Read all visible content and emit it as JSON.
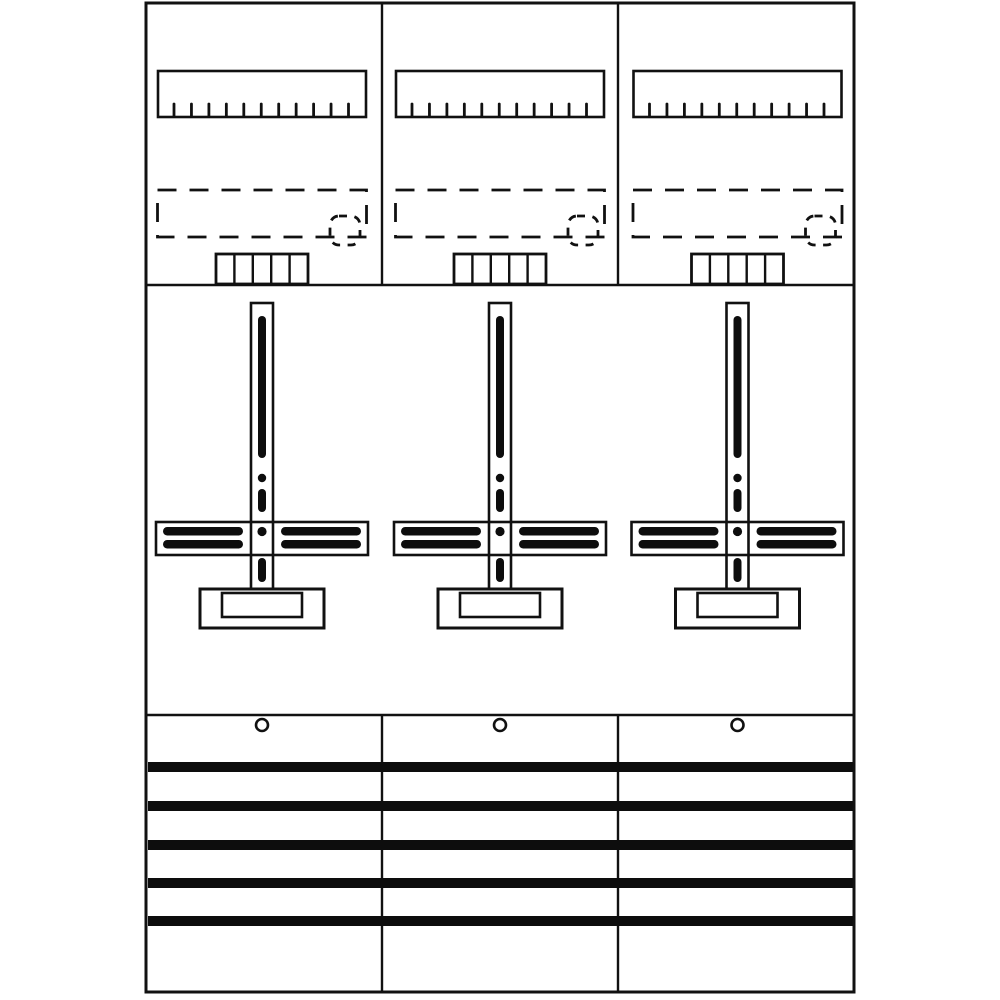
{
  "title": "meter-panel-technical-drawing",
  "colors": {
    "background": "#ffffff",
    "line": "#111111",
    "fill_black": "#0d0d0d",
    "fill_white": "#ffffff"
  },
  "drawing": {
    "canvas": {
      "width": 1000,
      "height": 1000
    },
    "frame": {
      "x": 146,
      "y": 3,
      "width": 708,
      "height": 989,
      "stroke_width": 3
    },
    "sections": {
      "top_divider_y": 285,
      "bottom_divider_y": 715,
      "line_stroke_width": 2.6
    },
    "columns": {
      "count": 3,
      "centers": [
        262,
        500,
        737.5
      ],
      "divider_xs": [
        382,
        618
      ],
      "divider_stroke_width": 2.4
    },
    "terminal_rail": {
      "name": "terminal rail",
      "y": 71,
      "width": 208,
      "height": 46,
      "stroke_width": 2.6,
      "tick_count": 11,
      "tick_top_y": 104,
      "tick_bottom_y": 116,
      "tick_span_start": -88,
      "tick_spacing": 17.45,
      "tick_stroke_width": 2.8
    },
    "dashed_zone": {
      "name": "dashed mounting zone",
      "y": 190,
      "width": 209,
      "height": 47,
      "stroke_width": 2.8,
      "dash_array": "19 13",
      "marker": {
        "offset_x": 68,
        "y": 216,
        "width": 30,
        "height": 29,
        "rx": 9,
        "dash_array": "8 7.5",
        "stroke_width": 2.8
      }
    },
    "comb": {
      "name": "busbar support comb",
      "y": 254,
      "width": 92,
      "height": 30,
      "cells": 5,
      "stroke_width": 2.8,
      "slot_stroke_width": 2.4
    },
    "cross": {
      "name": "meter mounting cross",
      "vbar": {
        "offset_x": -11,
        "y": 303,
        "width": 22,
        "height": 288,
        "stroke_width": 2.6
      },
      "vslot1": {
        "offset_x": -4,
        "y": 316,
        "width": 8,
        "height": 142,
        "rx": 4
      },
      "vdot": {
        "cy": 478,
        "r": 4.2
      },
      "vslot2": {
        "offset_x": -4,
        "y": 489,
        "width": 8,
        "height": 23,
        "rx": 4
      },
      "vslot3": {
        "offset_x": -4,
        "y": 558,
        "width": 8,
        "height": 24,
        "rx": 4
      },
      "hbar": {
        "offset_x": -106,
        "y": 522,
        "width": 212,
        "height": 33,
        "stroke_width": 2.6
      },
      "hslots": [
        {
          "offset_x": -99,
          "y": 527,
          "width": 80,
          "height": 8.5,
          "rx": 4.2
        },
        {
          "offset_x": -99,
          "y": 540,
          "width": 80,
          "height": 8.5,
          "rx": 4.2
        },
        {
          "offset_x": 19,
          "y": 527,
          "width": 80,
          "height": 8.5,
          "rx": 4.2
        },
        {
          "offset_x": 19,
          "y": 540,
          "width": 80,
          "height": 8.5,
          "rx": 4.2
        }
      ],
      "cdot": {
        "cy": 531.5,
        "r": 4.6
      },
      "base": {
        "offset_x": -62,
        "y": 589,
        "width": 124,
        "height": 39,
        "stroke_width": 3
      },
      "base_inset": {
        "offset_x": -40,
        "y": 593,
        "width": 80,
        "height": 24,
        "stroke_width": 2.6
      }
    },
    "mounting_hole": {
      "cy": 725,
      "r": 6,
      "stroke_width": 2.6
    },
    "busbars": {
      "name": "busbars",
      "count": 5,
      "x": 148,
      "width": 705,
      "height": 10,
      "y_positions": [
        762,
        801,
        840,
        878,
        916
      ]
    }
  }
}
